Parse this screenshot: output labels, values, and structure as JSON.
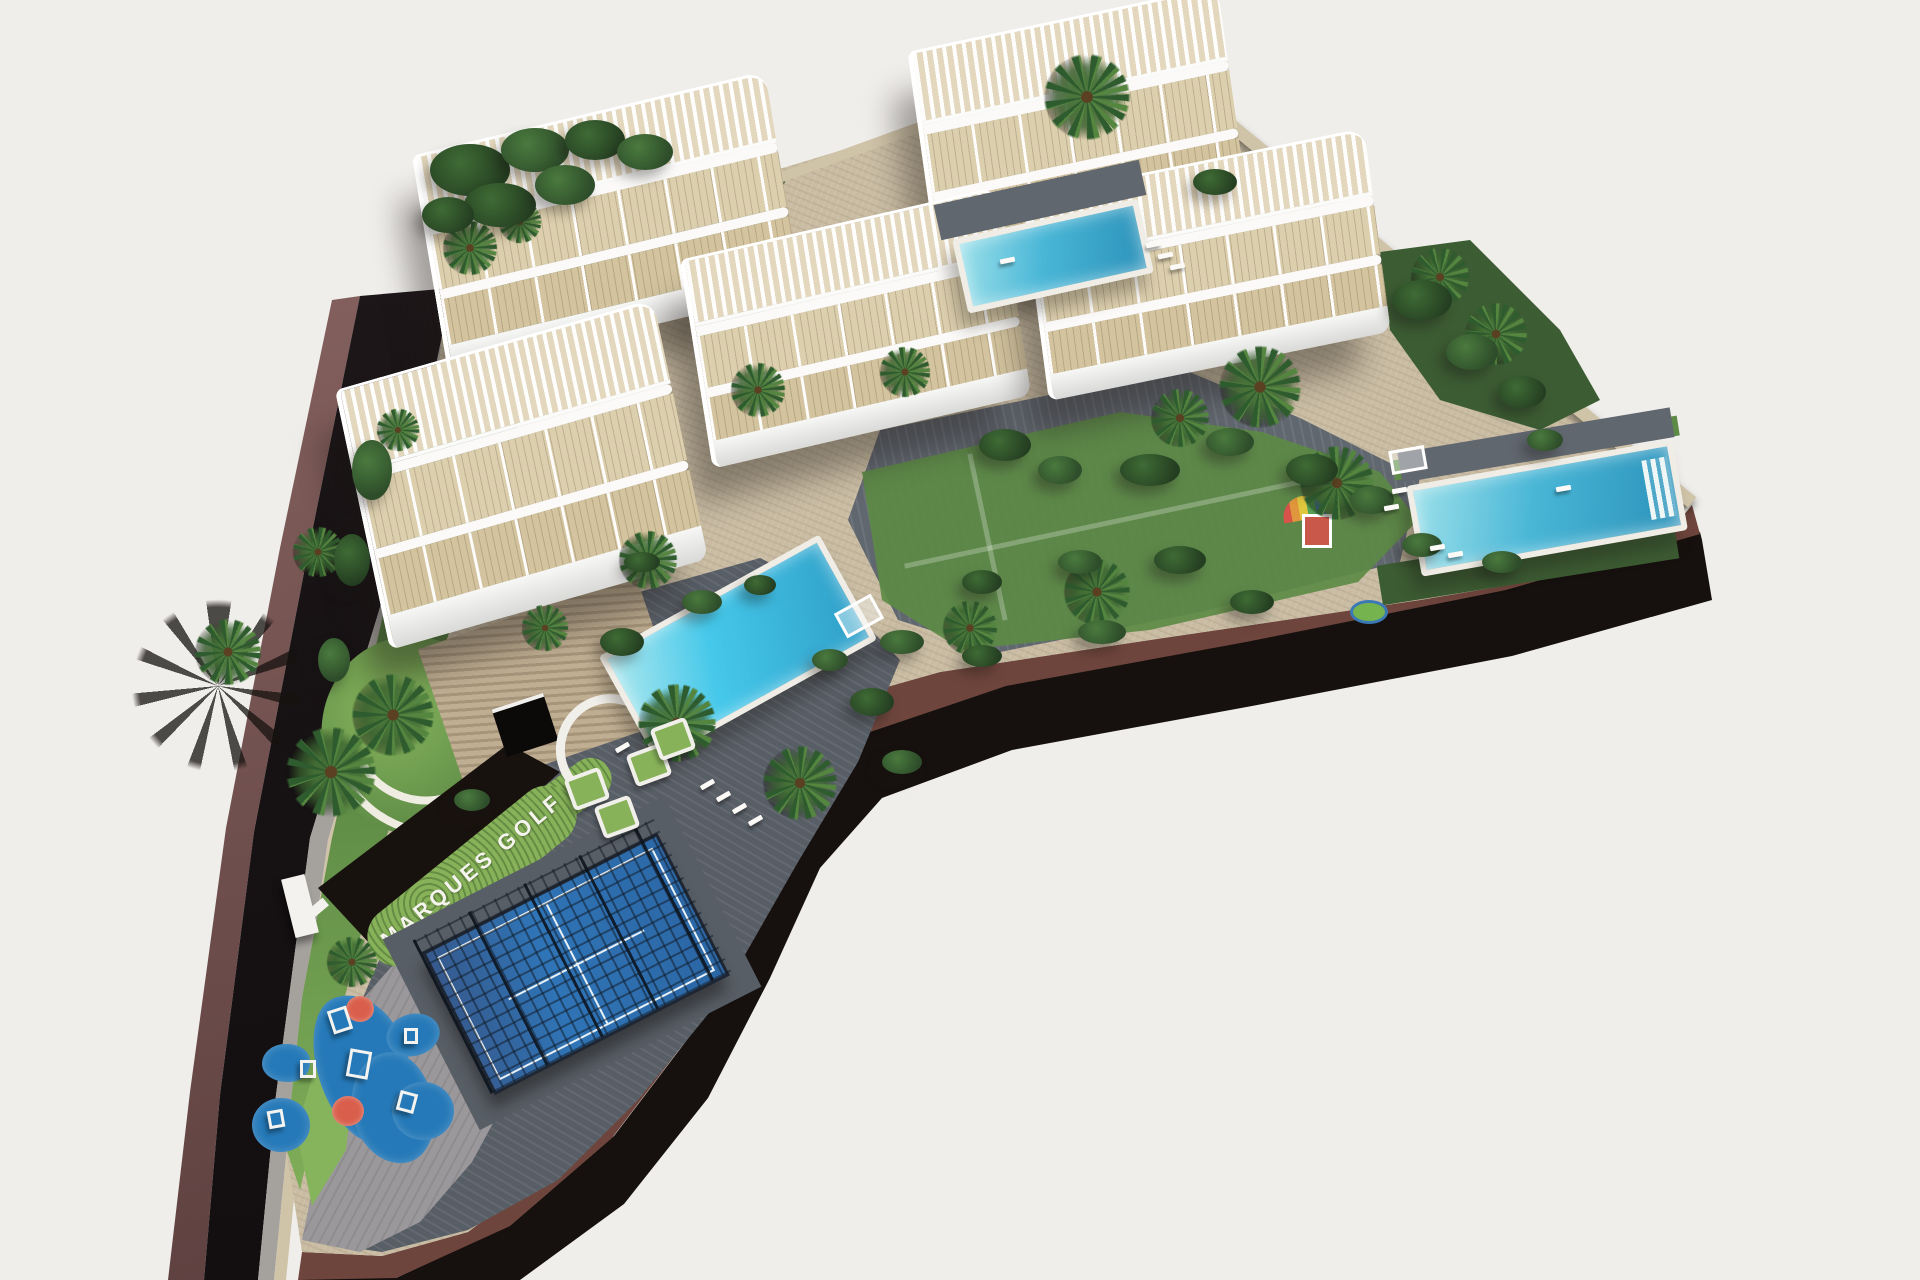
{
  "scene": {
    "site_label": "MARQUES GOLF",
    "buildings_count": 5,
    "pools_count": 3,
    "amenities": [
      "swimming pools",
      "padel court",
      "children playground",
      "palm gardens",
      "roof terraces with pergolas"
    ]
  },
  "colors": {
    "bg": "#f0eeeb",
    "asphalt": "#171214",
    "shoulder": "#8f6a67",
    "sidewalk": "#a5a29e",
    "wallStone": "#cfc3a8",
    "stoneBase": "#bfae92",
    "paveBeige": "#c9bca3",
    "paveDark": "#61676f",
    "paveMid": "#585e66",
    "paveLight": "#9b989c",
    "lawn": "#5d8a45",
    "lawnLight": "#86b45c",
    "lawnDark": "#3c5c33",
    "hedge": "#87b259",
    "palm": "#558640",
    "palmDark": "#2f5c2e",
    "pool": "#49b6d6",
    "poolDeep": "#2c92ba",
    "deck": "#f0ede6",
    "terrace": "#dccfae",
    "padel": "#2f74b6",
    "padelLine": "#e8f1f7",
    "fence": "#1d2632",
    "mat": "#2579b8",
    "matAccent": "#d95f4c",
    "brown": "#6e453c",
    "brownTop": "#a8876f",
    "shadowBand": "#16110e",
    "label": "#f6f4ee"
  }
}
